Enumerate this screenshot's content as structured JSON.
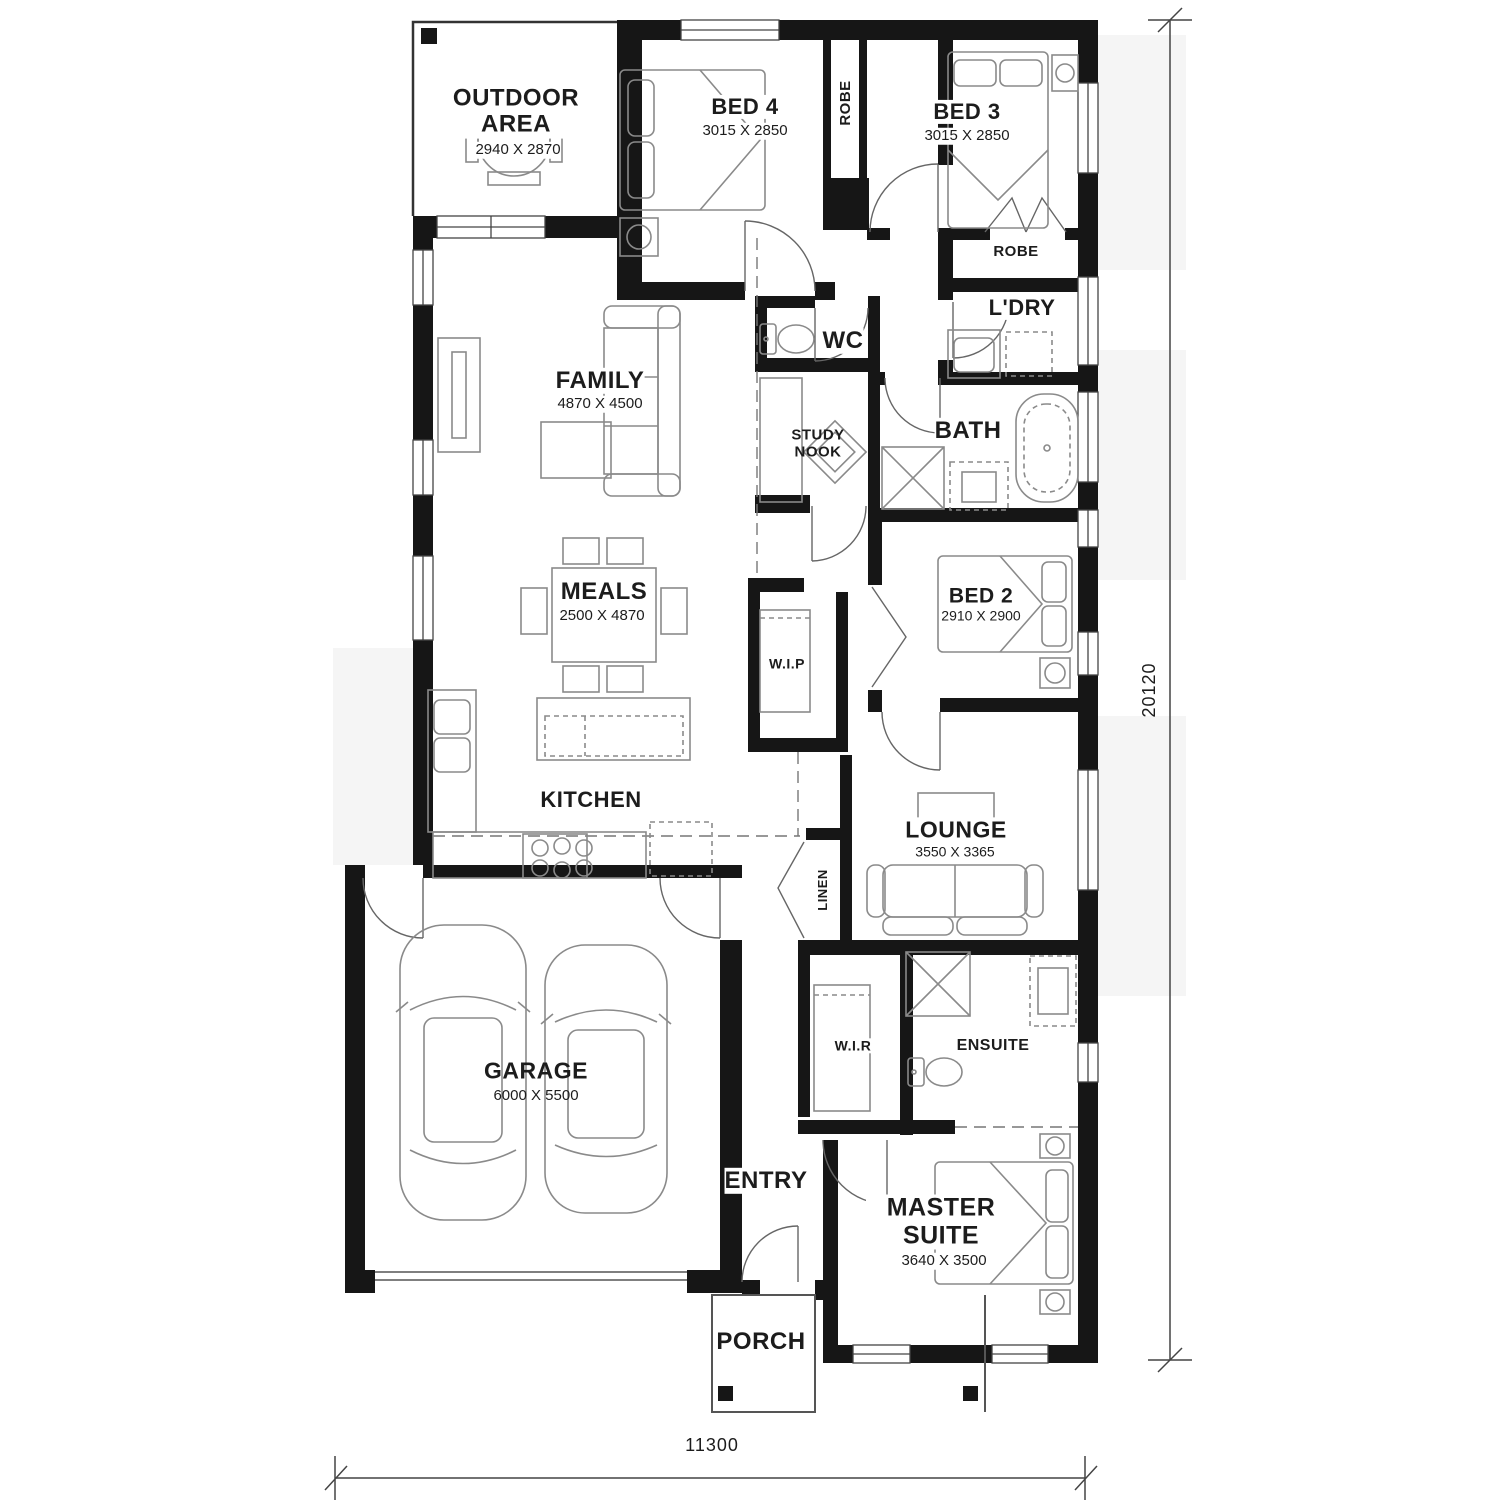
{
  "plan": {
    "rooms": {
      "outdoor": {
        "name": "OUTDOOR AREA",
        "dims": "2940 X 2870"
      },
      "bed4": {
        "name": "BED 4",
        "dims": "3015 X 2850"
      },
      "robe4": {
        "name": "ROBE"
      },
      "bed3": {
        "name": "BED 3",
        "dims": "3015 X 2850"
      },
      "robe3": {
        "name": "ROBE"
      },
      "laundry": {
        "name": "L'DRY"
      },
      "wc": {
        "name": "WC"
      },
      "family": {
        "name": "FAMILY",
        "dims": "4870 X 4500"
      },
      "study": {
        "name": "STUDY NOOK"
      },
      "bath": {
        "name": "BATH"
      },
      "meals": {
        "name": "MEALS",
        "dims": "2500 X 4870"
      },
      "bed2": {
        "name": "BED 2",
        "dims": "2910 X 2900"
      },
      "wip": {
        "name": "W.I.P"
      },
      "kitchen": {
        "name": "KITCHEN"
      },
      "lounge": {
        "name": "LOUNGE",
        "dims": "3550 X 3365"
      },
      "linen": {
        "name": "LINEN"
      },
      "garage": {
        "name": "GARAGE",
        "dims": "6000 X 5500"
      },
      "wir": {
        "name": "W.I.R"
      },
      "ensuite": {
        "name": "ENSUITE"
      },
      "entry": {
        "name": "ENTRY"
      },
      "master": {
        "name": "MASTER SUITE",
        "dims": "3640 X 3500"
      },
      "porch": {
        "name": "PORCH"
      }
    },
    "dimensions": {
      "overall_depth": "20120",
      "overall_width": "11300"
    },
    "colors": {
      "wall": "#161616",
      "furniture": "#8a8a8a",
      "shade": "#f5f5f5"
    }
  }
}
